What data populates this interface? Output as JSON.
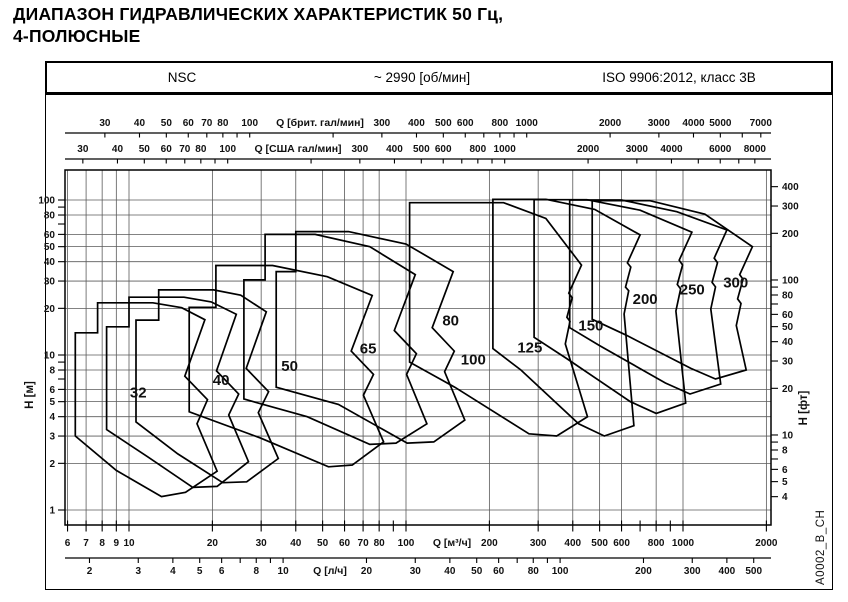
{
  "title_line1": "ДИАПАЗОН ГИДРАВЛИЧЕСКИХ ХАРАКТЕРИСТИК 50 Гц,",
  "title_line2": "4-ПОЛЮСНЫЕ",
  "header": {
    "series": "NSC",
    "speed": "~ 2990 [об/мин]",
    "standard": "ISO 9906:2012, класс 3B"
  },
  "watermark": "A0002_B_CH",
  "chart_data": {
    "type": "envelope-log-log",
    "title": "NSC pump family hydraulic coverage chart",
    "x_unit_primary": "м³/ч",
    "y_unit_primary": "м",
    "axes": {
      "imp_gpm": {
        "label": "Q [брит. гал/мин]",
        "to_m3h": 0.272765,
        "ticks": [
          30,
          40,
          50,
          60,
          70,
          80,
          90,
          100,
          200,
          300,
          400,
          500,
          600,
          700,
          800,
          900,
          1000,
          2000,
          3000,
          4000,
          5000,
          6000,
          7000
        ],
        "labeled": [
          30,
          40,
          50,
          60,
          70,
          80,
          100,
          300,
          400,
          500,
          600,
          800,
          1000,
          2000,
          3000,
          4000,
          5000,
          7000
        ]
      },
      "us_gpm": {
        "label": "Q [США гал/мин]",
        "to_m3h": 0.227125,
        "ticks": [
          30,
          40,
          50,
          60,
          70,
          80,
          90,
          100,
          200,
          300,
          400,
          500,
          600,
          700,
          800,
          900,
          1000,
          2000,
          3000,
          4000,
          5000,
          6000,
          7000,
          8000
        ],
        "labeled": [
          30,
          40,
          50,
          60,
          70,
          80,
          100,
          300,
          400,
          500,
          600,
          800,
          1000,
          2000,
          3000,
          4000,
          6000,
          8000
        ]
      },
      "m3h": {
        "label": "Q [м³/ч]",
        "to_m3h": 1,
        "ticks": [
          6,
          7,
          8,
          9,
          10,
          20,
          30,
          40,
          50,
          60,
          70,
          80,
          90,
          100,
          200,
          300,
          400,
          500,
          600,
          700,
          800,
          900,
          1000,
          2000
        ],
        "labeled": [
          6,
          7,
          8,
          9,
          10,
          20,
          30,
          40,
          50,
          60,
          70,
          80,
          100,
          200,
          300,
          400,
          500,
          600,
          800,
          1000,
          2000
        ]
      },
      "ls": {
        "label": "Q [л/ч]",
        "to_m3h": 3.6,
        "ticks": [
          2,
          3,
          4,
          5,
          6,
          7,
          8,
          9,
          10,
          20,
          30,
          40,
          50,
          60,
          70,
          80,
          90,
          100,
          200,
          300,
          400,
          500
        ],
        "labeled": [
          2,
          3,
          4,
          5,
          6,
          8,
          10,
          20,
          30,
          40,
          50,
          60,
          80,
          100,
          200,
          300,
          400,
          500
        ]
      },
      "h_m": {
        "label": "H [м]",
        "to_m": 1,
        "ticks": [
          1,
          2,
          3,
          4,
          5,
          6,
          7,
          8,
          9,
          10,
          20,
          30,
          40,
          50,
          60,
          70,
          80,
          90,
          100
        ],
        "labeled": [
          1,
          2,
          3,
          4,
          5,
          6,
          8,
          10,
          20,
          30,
          40,
          50,
          60,
          80,
          100
        ]
      },
      "h_ft": {
        "label": "H [фт]",
        "to_m": 0.3048,
        "ticks": [
          4,
          5,
          6,
          7,
          8,
          9,
          10,
          20,
          30,
          40,
          50,
          60,
          70,
          80,
          90,
          100,
          200,
          300,
          400
        ],
        "labeled": [
          4,
          5,
          6,
          8,
          10,
          20,
          30,
          40,
          50,
          60,
          80,
          100,
          200,
          300,
          400
        ]
      }
    },
    "grid": {
      "q_lines": [
        6,
        7,
        8,
        9,
        10,
        20,
        30,
        40,
        50,
        60,
        70,
        80,
        100,
        200,
        300,
        400,
        500,
        600,
        800,
        1000,
        2000
      ],
      "h_lines": [
        1,
        2,
        3,
        4,
        5,
        6,
        8,
        10,
        20,
        30,
        40,
        50,
        60,
        80,
        100
      ]
    },
    "envelopes": [
      {
        "label": "32",
        "label_pos": [
          10.8,
          5.3
        ],
        "points": [
          [
            6.4,
            3.0
          ],
          [
            6.4,
            13.9
          ],
          [
            7.7,
            13.9
          ],
          [
            7.7,
            21.7
          ],
          [
            12.2,
            21.7
          ],
          [
            15.5,
            20.2
          ],
          [
            18.8,
            16.9
          ],
          [
            15.9,
            7.3
          ],
          [
            19.2,
            5.15
          ],
          [
            17.6,
            3.6
          ],
          [
            20.8,
            1.78
          ],
          [
            16.0,
            1.3
          ],
          [
            13.1,
            1.22
          ],
          [
            9.0,
            1.8
          ]
        ]
      },
      {
        "label": "40",
        "label_pos": [
          21.5,
          6.4
        ],
        "points": [
          [
            8.3,
            3.3
          ],
          [
            8.3,
            15.2
          ],
          [
            10.0,
            15.2
          ],
          [
            10.0,
            23.6
          ],
          [
            15.8,
            23.6
          ],
          [
            19.8,
            22.0
          ],
          [
            24.4,
            18.3
          ],
          [
            20.7,
            7.9
          ],
          [
            24.9,
            5.6
          ],
          [
            22.9,
            4.1
          ],
          [
            27.0,
            2.05
          ],
          [
            20.8,
            1.42
          ],
          [
            17.0,
            1.4
          ],
          [
            11.7,
            2.2
          ]
        ]
      },
      {
        "label": "50",
        "label_pos": [
          38,
          7.9
        ],
        "points": [
          [
            10.6,
            3.7
          ],
          [
            10.6,
            16.8
          ],
          [
            12.8,
            16.8
          ],
          [
            12.8,
            26.3
          ],
          [
            20.2,
            26.3
          ],
          [
            25.3,
            24.3
          ],
          [
            31.3,
            19.0
          ],
          [
            26.5,
            8.2
          ],
          [
            31.9,
            5.8
          ],
          [
            29.3,
            4.25
          ],
          [
            34.6,
            2.15
          ],
          [
            26.6,
            1.52
          ],
          [
            21.8,
            1.5
          ],
          [
            15.0,
            2.3
          ]
        ]
      },
      {
        "label": "65",
        "label_pos": [
          73,
          10.2
        ],
        "points": [
          [
            16.5,
            4.3
          ],
          [
            16.5,
            20.3
          ],
          [
            20.6,
            20.3
          ],
          [
            20.6,
            37.8
          ],
          [
            33.0,
            37.8
          ],
          [
            52.0,
            32.0
          ],
          [
            75.5,
            24.2
          ],
          [
            63.4,
            10.6
          ],
          [
            76.3,
            7.5
          ],
          [
            70.2,
            5.5
          ],
          [
            83.0,
            2.75
          ],
          [
            64.0,
            1.95
          ],
          [
            52.5,
            1.9
          ],
          [
            30.0,
            2.9
          ]
        ]
      },
      {
        "label": "80",
        "label_pos": [
          145,
          15.5
        ],
        "points": [
          [
            26.0,
            5.2
          ],
          [
            26.0,
            30.5
          ],
          [
            31.0,
            30.5
          ],
          [
            31.0,
            60.0
          ],
          [
            47.0,
            60.0
          ],
          [
            74.0,
            50.0
          ],
          [
            108.0,
            33.0
          ],
          [
            90.7,
            14.4
          ],
          [
            109.0,
            10.2
          ],
          [
            100.5,
            7.5
          ],
          [
            119.0,
            3.6
          ],
          [
            92.0,
            2.7
          ],
          [
            74.0,
            2.65
          ],
          [
            44.0,
            4.0
          ]
        ]
      },
      {
        "label": "100",
        "label_pos": [
          175,
          8.7
        ],
        "points": [
          [
            34.0,
            6.2
          ],
          [
            34.0,
            34.5
          ],
          [
            40.0,
            34.5
          ],
          [
            40.0,
            62.5
          ],
          [
            62.0,
            62.5
          ],
          [
            100.0,
            52.0
          ],
          [
            148.0,
            34.5
          ],
          [
            124.3,
            15.0
          ],
          [
            149.4,
            10.6
          ],
          [
            137.8,
            7.8
          ],
          [
            163.0,
            3.8
          ],
          [
            126.0,
            2.75
          ],
          [
            101.0,
            2.7
          ],
          [
            57.0,
            4.8
          ]
        ]
      },
      {
        "label": "125",
        "label_pos": [
          280,
          10.4
        ],
        "points": [
          [
            103.0,
            9.0
          ],
          [
            103.0,
            96.0
          ],
          [
            225.0,
            96.0
          ],
          [
            320.0,
            76.0
          ],
          [
            430.0,
            38.0
          ],
          [
            387.0,
            25.1
          ],
          [
            398.0,
            23.4
          ],
          [
            381.0,
            17.5
          ],
          [
            391.0,
            16.5
          ],
          [
            376.0,
            11.8
          ],
          [
            452.0,
            4.0
          ],
          [
            350.0,
            3.0
          ],
          [
            278.0,
            3.1
          ],
          [
            150.0,
            6.2
          ]
        ]
      },
      {
        "label": "150",
        "label_pos": [
          465,
          14.4
        ],
        "points": [
          [
            206.0,
            11.0
          ],
          [
            206.0,
            101.0
          ],
          [
            320.0,
            101.0
          ],
          [
            480.0,
            87.0
          ],
          [
            700.0,
            59.5
          ],
          [
            630.0,
            39.3
          ],
          [
            648.0,
            36.9
          ],
          [
            620.0,
            27.4
          ],
          [
            637.0,
            26.0
          ],
          [
            613.0,
            18.4
          ],
          [
            665.0,
            3.5
          ],
          [
            520.0,
            3.0
          ],
          [
            420.0,
            3.6
          ],
          [
            260.0,
            8.0
          ]
        ]
      },
      {
        "label": "200",
        "label_pos": [
          730,
          21.3
        ],
        "points": [
          [
            290.0,
            13.0
          ],
          [
            290.0,
            100.5
          ],
          [
            450.0,
            100.5
          ],
          [
            700.0,
            86.0
          ],
          [
            1077.0,
            62.0
          ],
          [
            969.0,
            40.9
          ],
          [
            997.0,
            38.1
          ],
          [
            954.0,
            28.5
          ],
          [
            980.0,
            26.7
          ],
          [
            943.0,
            19.2
          ],
          [
            1023.0,
            4.9
          ],
          [
            800.0,
            4.2
          ],
          [
            646.0,
            5.0
          ],
          [
            380.0,
            9.5
          ]
        ]
      },
      {
        "label": "250",
        "label_pos": [
          1080,
          24.5
        ],
        "points": [
          [
            390.0,
            15.0
          ],
          [
            390.0,
            100.0
          ],
          [
            600.0,
            100.0
          ],
          [
            950.0,
            84.0
          ],
          [
            1440.0,
            64.0
          ],
          [
            1296.0,
            42.2
          ],
          [
            1332.0,
            39.4
          ],
          [
            1274.0,
            29.4
          ],
          [
            1310.0,
            27.5
          ],
          [
            1260.0,
            19.8
          ],
          [
            1368.0,
            6.5
          ],
          [
            1060.0,
            5.6
          ],
          [
            864.0,
            6.6
          ],
          [
            500.0,
            11.5
          ]
        ]
      },
      {
        "label": "300",
        "label_pos": [
          1550,
          27.2
        ],
        "points": [
          [
            470.0,
            17.0
          ],
          [
            470.0,
            99.0
          ],
          [
            760.0,
            99.0
          ],
          [
            1200.0,
            81.0
          ],
          [
            1780.0,
            50.0
          ],
          [
            1602.0,
            33.0
          ],
          [
            1647.0,
            30.8
          ],
          [
            1575.0,
            23.0
          ],
          [
            1619.0,
            21.5
          ],
          [
            1557.0,
            15.5
          ],
          [
            1691.0,
            8.0
          ],
          [
            1310.0,
            7.0
          ],
          [
            1068.0,
            8.2
          ],
          [
            620.0,
            13.5
          ]
        ]
      }
    ]
  }
}
